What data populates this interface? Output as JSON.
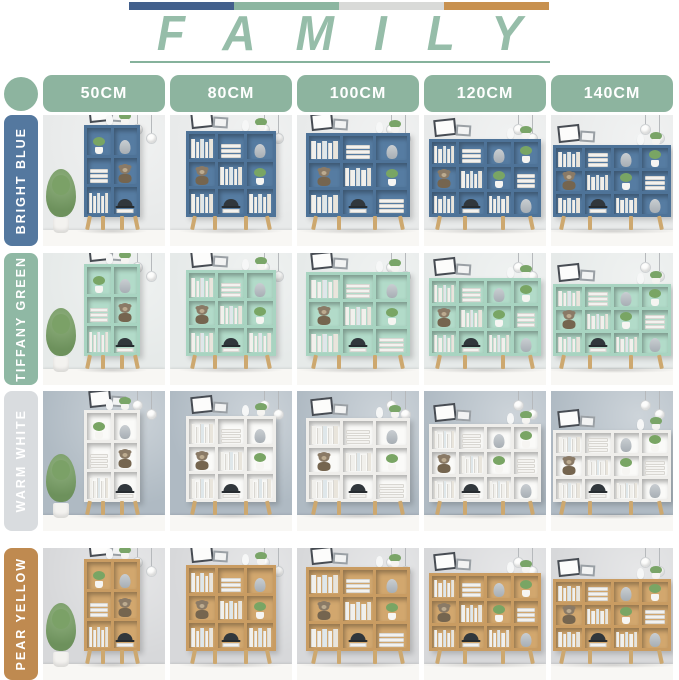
{
  "header": {
    "title": "FAMILY",
    "title_color": "#96BDA9",
    "underline_color": "#86B29C",
    "bar_colors": [
      "#43608C",
      "#8CB6A1",
      "#D9DAD8",
      "#C8914F"
    ]
  },
  "size_header": {
    "pill_color": "#8DB49F",
    "text_color": "#FFFFFF"
  },
  "size_columns": [
    {
      "label": "50CM",
      "shelf_cols": 2,
      "shelf_w": 56,
      "shelf_h": 92,
      "has_plant": true,
      "compartment_items": [
        "plant",
        "vase",
        "stack",
        "bear",
        "books",
        "hat"
      ]
    },
    {
      "label": "80CM",
      "shelf_cols": 3,
      "shelf_w": 90,
      "shelf_h": 86,
      "has_plant": false,
      "compartment_items": [
        "books",
        "stack",
        "vase",
        "bear",
        "books",
        "plant",
        "books",
        "hat",
        "books"
      ]
    },
    {
      "label": "100CM",
      "shelf_cols": 3,
      "shelf_w": 104,
      "shelf_h": 84,
      "has_plant": false,
      "compartment_items": [
        "books",
        "stack",
        "vase",
        "bear",
        "books",
        "plant",
        "books",
        "hat",
        "stack"
      ]
    },
    {
      "label": "120CM",
      "shelf_cols": 4,
      "shelf_w": 112,
      "shelf_h": 78,
      "has_plant": false,
      "compartment_items": [
        "books",
        "stack",
        "vase",
        "plant",
        "bear",
        "books",
        "plant",
        "stack",
        "books",
        "hat",
        "books",
        "vase"
      ]
    },
    {
      "label": "140CM",
      "shelf_cols": 4,
      "shelf_w": 118,
      "shelf_h": 72,
      "has_plant": false,
      "compartment_items": [
        "books",
        "stack",
        "vase",
        "plant",
        "bear",
        "books",
        "plant",
        "stack",
        "books",
        "hat",
        "books",
        "vase"
      ]
    }
  ],
  "color_rows": [
    {
      "label": "BRIGHT BLUE",
      "pill_color": "#54789F",
      "shelf_color": "#4E7398",
      "shelf_back": "#567CA2",
      "wall_color": "#E8EAEA"
    },
    {
      "label": "TIFFANY GREEN",
      "pill_color": "#8FB8A4",
      "shelf_color": "#A8D4C1",
      "shelf_back": "#B2DBC9",
      "wall_color": "#E6EAE9"
    },
    {
      "label": "WARM WHITE",
      "pill_color": "#D9DCDF",
      "shelf_color": "#EFEEEB",
      "shelf_back": "#FAFAF8",
      "wall_color": "#AFBAC3"
    },
    {
      "label": "PEAR YELLOW",
      "pill_color": "#BF8A50",
      "shelf_color": "#C99C62",
      "shelf_back": "#D2A76E",
      "wall_color": "#D7D8DA"
    }
  ],
  "scene": {
    "legs_color": "#CDA86F",
    "floor_color": "#F8F7F4",
    "decor_items": [
      "picture-frame",
      "pendant-lamp",
      "potted-plant",
      "bust-vase",
      "books",
      "teddy-bear",
      "hat"
    ]
  }
}
